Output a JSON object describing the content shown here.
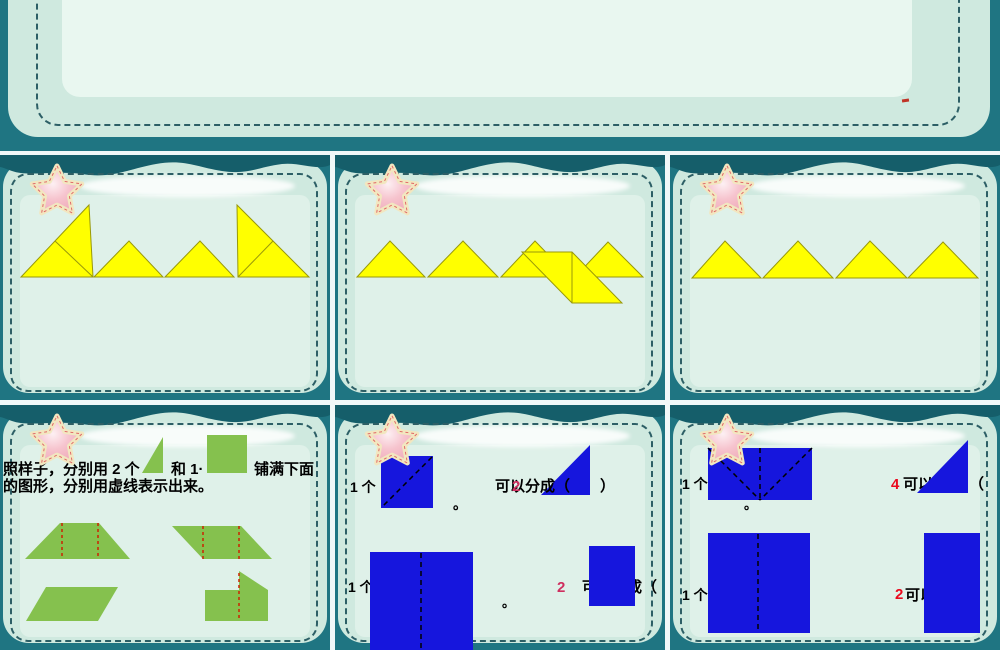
{
  "theme": {
    "teal": "#1f7582",
    "tealDark": "#155e6a",
    "mint": "#cfe9df",
    "mintLight": "#dff1e9",
    "dash": "#2d5f66",
    "gap": "#f1f8f8",
    "yellow": "#ffff00",
    "yellowEdge": "#98980a",
    "green": "#85c14e",
    "redDash": "#cc2200",
    "blue": "#1616dd",
    "pinkAnswer": "#cf2f5f",
    "redAnswer": "#ea0a1e",
    "starPink": "#f2b3c0",
    "starRim": "#f2e7c0"
  },
  "top_slide": {
    "red_mark": {
      "x": 902,
      "y": 99,
      "w": 7,
      "h": 3,
      "color": "#c03326"
    }
  },
  "slides": [
    {
      "id": "r1c1",
      "x": 0,
      "y": 155,
      "items": [
        {
          "t": "poly",
          "n": "yellow-big-right-triangle-left",
          "p": "21,122 89,50 93,122",
          "f": "#ffff00",
          "st": "#98980a"
        },
        {
          "t": "line",
          "n": "triangle-divider-line",
          "x1": 55,
          "y1": 86,
          "x2": 93,
          "y2": 122,
          "st": "#98980a"
        },
        {
          "t": "poly",
          "n": "yellow-triangle",
          "p": "94,122 129,86 163,122",
          "f": "#ffff00",
          "st": "#98980a"
        },
        {
          "t": "poly",
          "n": "yellow-triangle",
          "p": "165,122 200,86 234,122",
          "f": "#ffff00",
          "st": "#98980a"
        },
        {
          "t": "poly",
          "n": "yellow-big-right-triangle-right",
          "p": "237,50 309,122 238,122",
          "f": "#ffff00",
          "st": "#98980a"
        },
        {
          "t": "line",
          "n": "triangle-divider-line",
          "x1": 273,
          "y1": 86,
          "x2": 238,
          "y2": 122,
          "st": "#98980a"
        }
      ]
    },
    {
      "id": "r1c2",
      "x": 335,
      "y": 155,
      "items": [
        {
          "t": "poly",
          "n": "yellow-triangle",
          "p": "22,122 55,86 90,122",
          "f": "#ffff00",
          "st": "#98980a"
        },
        {
          "t": "poly",
          "n": "yellow-triangle",
          "p": "93,122 128,86 163,122",
          "f": "#ffff00",
          "st": "#98980a"
        },
        {
          "t": "poly",
          "n": "yellow-triangle",
          "p": "166,122 200,86 235,122",
          "f": "#ffff00",
          "st": "#98980a"
        },
        {
          "t": "poly",
          "n": "yellow-triangle",
          "p": "240,122 273,87 308,122",
          "f": "#ffff00",
          "st": "#98980a"
        },
        {
          "t": "poly",
          "n": "yellow-parallelogram",
          "p": "187,97 237,97 287,148 237,148",
          "f": "#ffff00",
          "st": "#98980a"
        },
        {
          "t": "line",
          "n": "parallelogram-divider-line",
          "x1": 237,
          "y1": 97,
          "x2": 237,
          "y2": 148,
          "st": "#98980a"
        }
      ]
    },
    {
      "id": "r1c3",
      "x": 670,
      "y": 155,
      "items": [
        {
          "t": "poly",
          "n": "yellow-triangle",
          "p": "22,123 55,86 91,123",
          "f": "#ffff00",
          "st": "#98980a"
        },
        {
          "t": "poly",
          "n": "yellow-triangle",
          "p": "93,123 128,86 163,123",
          "f": "#ffff00",
          "st": "#98980a"
        },
        {
          "t": "poly",
          "n": "yellow-triangle",
          "p": "166,123 200,86 237,123",
          "f": "#ffff00",
          "st": "#98980a"
        },
        {
          "t": "poly",
          "n": "yellow-triangle",
          "p": "238,123 273,87 308,123",
          "f": "#ffff00",
          "st": "#98980a"
        }
      ]
    },
    {
      "id": "r2c1",
      "x": 0,
      "y": 405,
      "items": [
        {
          "t": "text",
          "n": "instruction-text-part1",
          "s": "照样子，分别用 2 个",
          "x": 3,
          "y": 69,
          "size": 15,
          "f": "#000"
        },
        {
          "t": "poly",
          "n": "green-triangle-icon",
          "p": "163,32 163,68 142,68",
          "f": "#85c14e"
        },
        {
          "t": "text",
          "n": "instruction-text-part2",
          "s": "和 1·",
          "x": 171,
          "y": 69,
          "size": 15,
          "f": "#000"
        },
        {
          "t": "rect",
          "n": "green-square-icon",
          "x": 207,
          "y": 30,
          "w": 40,
          "h": 38,
          "f": "#85c14e"
        },
        {
          "t": "text",
          "n": "instruction-text-part3",
          "s": "铺满下面",
          "x": 254,
          "y": 69,
          "size": 15,
          "f": "#000"
        },
        {
          "t": "text",
          "n": "instruction-text-line2",
          "s": "的图形，分别用虚线表示出来。",
          "x": 3,
          "y": 86,
          "size": 15,
          "f": "#000"
        },
        {
          "t": "poly",
          "n": "green-trapezoid",
          "p": "60,118 99,118 130,154 25,154",
          "f": "#85c14e"
        },
        {
          "t": "line",
          "n": "red-dashed-divider",
          "x1": 62,
          "y1": 118,
          "x2": 62,
          "y2": 154,
          "st": "#cc2200",
          "sw": 1.5,
          "d": "3,3"
        },
        {
          "t": "line",
          "n": "red-dashed-divider",
          "x1": 98,
          "y1": 118,
          "x2": 98,
          "y2": 154,
          "st": "#cc2200",
          "sw": 1.5,
          "d": "3,3"
        },
        {
          "t": "poly",
          "n": "green-parallelogram",
          "p": "172,121 241,121 272,154 203,154",
          "f": "#85c14e"
        },
        {
          "t": "line",
          "n": "red-dashed-divider",
          "x1": 203,
          "y1": 121,
          "x2": 203,
          "y2": 154,
          "st": "#cc2200",
          "sw": 1.5,
          "d": "3,3"
        },
        {
          "t": "line",
          "n": "red-dashed-divider",
          "x1": 239,
          "y1": 121,
          "x2": 239,
          "y2": 154,
          "st": "#cc2200",
          "sw": 1.5,
          "d": "3,3"
        },
        {
          "t": "poly",
          "n": "green-parallelogram-partial",
          "p": "46,182 118,182 98,216 26,216",
          "f": "#85c14e"
        },
        {
          "t": "poly",
          "n": "green-shape-partial",
          "p": "239,166 268,185 268,216 205,216 205,185 239,185",
          "f": "#85c14e"
        },
        {
          "t": "line",
          "n": "red-dashed-divider",
          "x1": 239,
          "y1": 168,
          "x2": 239,
          "y2": 216,
          "st": "#cc2200",
          "sw": 1.5,
          "d": "3,3"
        }
      ]
    },
    {
      "id": "r2c2",
      "x": 335,
      "y": 405,
      "items": [
        {
          "t": "rect",
          "n": "blue-square",
          "x": 46,
          "y": 51,
          "w": 52,
          "h": 52,
          "f": "#1616dd"
        },
        {
          "t": "line",
          "n": "black-dashed-diagonal",
          "x1": 97,
          "y1": 52,
          "x2": 47,
          "y2": 102,
          "st": "#000000",
          "sw": 1.5,
          "d": "5,4"
        },
        {
          "t": "poly",
          "n": "blue-right-triangle",
          "p": "255,40 255,90 206,90",
          "f": "#1616dd"
        },
        {
          "t": "text",
          "n": "question-prefix",
          "s": "1 个",
          "x": 15,
          "y": 87,
          "size": 14,
          "f": "#000"
        },
        {
          "t": "text",
          "n": "question-text",
          "s": "可以分成（　　）",
          "x": 160,
          "y": 86,
          "size": 15,
          "f": "#000"
        },
        {
          "t": "text",
          "n": "answer-number",
          "s": "2",
          "x": 177,
          "y": 86,
          "size": 15,
          "f": "#cf2f5f"
        },
        {
          "t": "text",
          "n": "period-mark",
          "s": "。",
          "x": 118,
          "y": 104,
          "size": 14,
          "f": "#000"
        },
        {
          "t": "text",
          "n": "question-prefix",
          "s": "1 个",
          "x": 13,
          "y": 187,
          "size": 14,
          "f": "#000"
        },
        {
          "t": "rect",
          "n": "blue-rectangle",
          "x": 35,
          "y": 147,
          "w": 103,
          "h": 100,
          "f": "#1616dd"
        },
        {
          "t": "line",
          "n": "black-dashed-midline",
          "x1": 86,
          "y1": 148,
          "x2": 86,
          "y2": 246,
          "st": "#000000",
          "sw": 1.5,
          "d": "5,4"
        },
        {
          "t": "text",
          "n": "answer-number",
          "s": "2",
          "x": 222,
          "y": 187,
          "size": 15,
          "f": "#cf2f5f"
        },
        {
          "t": "text",
          "n": "question-text",
          "s": "可以分成（",
          "x": 247,
          "y": 187,
          "size": 15,
          "f": "#000"
        },
        {
          "t": "rect",
          "n": "blue-square",
          "x": 254,
          "y": 141,
          "w": 46,
          "h": 60,
          "f": "#1616dd"
        },
        {
          "t": "text",
          "n": "period-mark",
          "s": "。",
          "x": 167,
          "y": 202,
          "size": 13,
          "f": "#000"
        }
      ]
    },
    {
      "id": "r2c3",
      "x": 670,
      "y": 405,
      "items": [
        {
          "t": "text",
          "n": "question-text",
          "s": "可以",
          "x": 233,
          "y": 84,
          "size": 15,
          "f": "#000"
        },
        {
          "t": "text",
          "n": "question-text",
          "s": "（",
          "x": 299,
          "y": 84,
          "size": 15,
          "f": "#000"
        },
        {
          "t": "poly",
          "n": "blue-right-triangle",
          "p": "298,35 298,88 247,88",
          "f": "#1616dd"
        },
        {
          "t": "rect",
          "n": "blue-rectangle",
          "x": 38,
          "y": 43,
          "w": 104,
          "h": 52,
          "f": "#1616dd"
        },
        {
          "t": "line",
          "n": "black-dashed-diagonal",
          "x1": 38,
          "y1": 43,
          "x2": 90,
          "y2": 95,
          "st": "#000000",
          "sw": 1.5,
          "d": "5,4"
        },
        {
          "t": "line",
          "n": "black-dashed-diagonal",
          "x1": 142,
          "y1": 43,
          "x2": 90,
          "y2": 95,
          "st": "#000000",
          "sw": 1.5,
          "d": "5,4"
        },
        {
          "t": "line",
          "n": "black-dashed-midline",
          "x1": 90,
          "y1": 43,
          "x2": 90,
          "y2": 95,
          "st": "#000000",
          "sw": 1.5,
          "d": "5,4"
        },
        {
          "t": "text",
          "n": "question-prefix",
          "s": "1 个",
          "x": 12,
          "y": 84,
          "size": 14,
          "f": "#000"
        },
        {
          "t": "text",
          "n": "answer-number",
          "s": "4",
          "x": 221,
          "y": 84,
          "size": 15,
          "f": "#ea0a1e"
        },
        {
          "t": "text",
          "n": "period-mark",
          "s": "。",
          "x": 74,
          "y": 104,
          "size": 13,
          "f": "#000"
        },
        {
          "t": "text",
          "n": "question-prefix",
          "s": "1 个",
          "x": 12,
          "y": 195,
          "size": 14,
          "f": "#000"
        },
        {
          "t": "rect",
          "n": "blue-rectangle",
          "x": 38,
          "y": 128,
          "w": 102,
          "h": 100,
          "f": "#1616dd"
        },
        {
          "t": "line",
          "n": "black-dashed-midline",
          "x1": 88,
          "y1": 129,
          "x2": 88,
          "y2": 228,
          "st": "#000000",
          "sw": 1.5,
          "d": "5,4"
        },
        {
          "t": "text",
          "n": "answer-number",
          "s": "2",
          "x": 225,
          "y": 194,
          "size": 15,
          "f": "#ea0a1e"
        },
        {
          "t": "text",
          "n": "question-text",
          "s": "可以分成（",
          "x": 235,
          "y": 195,
          "size": 15,
          "f": "#000"
        },
        {
          "t": "rect",
          "n": "blue-square",
          "x": 254,
          "y": 128,
          "w": 56,
          "h": 100,
          "f": "#1616dd"
        }
      ]
    }
  ]
}
